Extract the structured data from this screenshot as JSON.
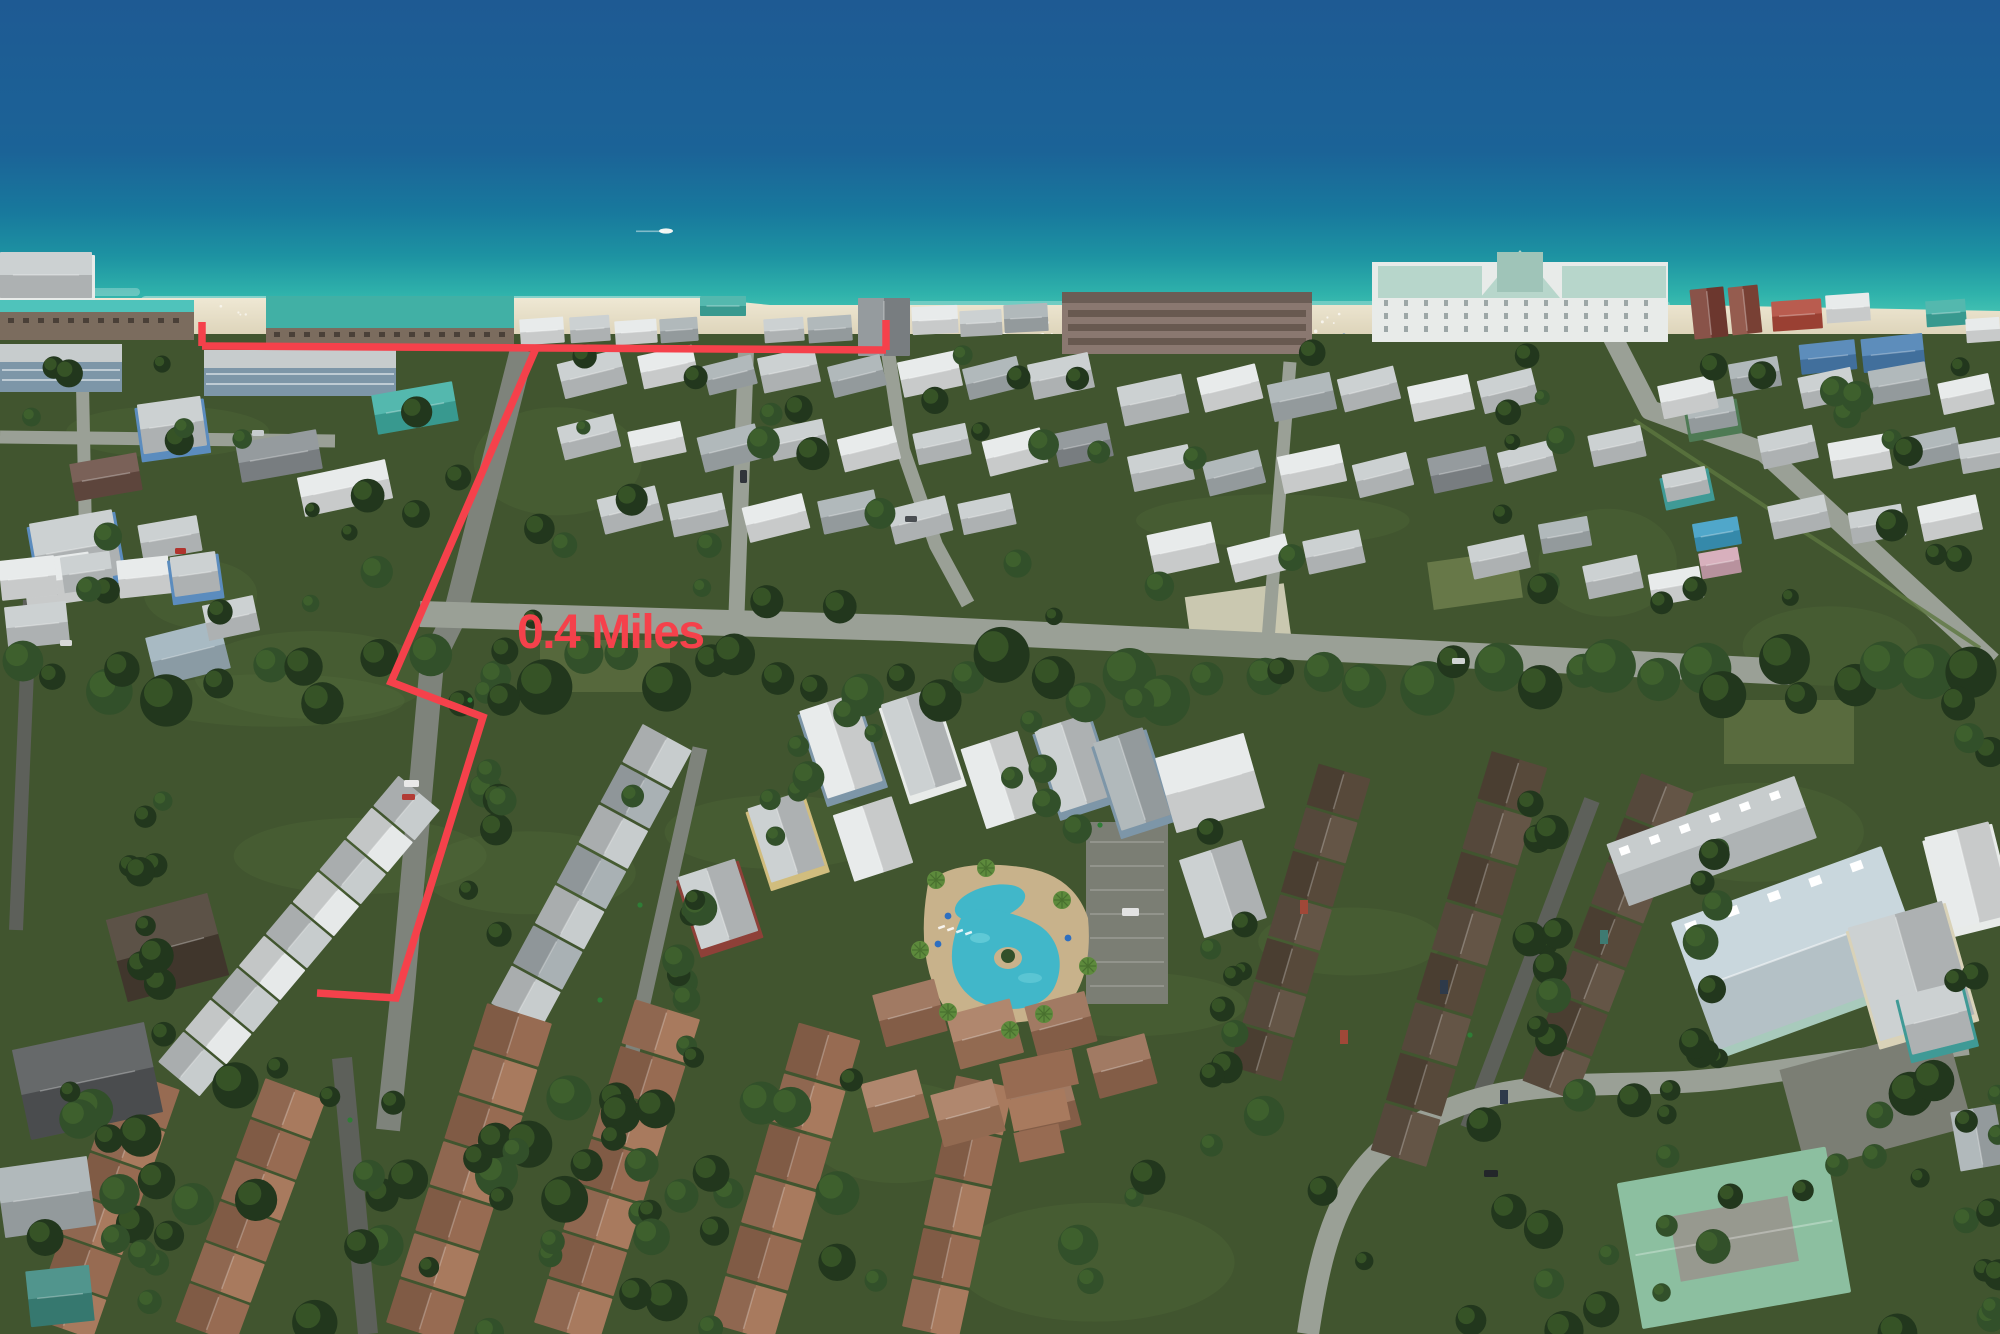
{
  "annotation": {
    "distance_label": "0.4 Miles",
    "color": "#f5414b",
    "stroke_width": 7.5,
    "label": {
      "x": 517,
      "y": 648,
      "font_size": 48
    },
    "beach_line": [
      [
        202,
        346
      ],
      [
        886,
        350
      ]
    ],
    "start_tick": [
      [
        202,
        346
      ],
      [
        202,
        322
      ]
    ],
    "end_tick": [
      [
        886,
        350
      ],
      [
        886,
        320
      ]
    ],
    "route_line": [
      [
        537,
        346
      ],
      [
        391,
        682
      ],
      [
        483,
        717
      ],
      [
        396,
        998
      ],
      [
        317,
        993
      ]
    ]
  },
  "scene": {
    "type": "aerial-photo",
    "subject": "beach neighborhood with route to shoreline marked in red",
    "palette": {
      "ocean_deep": "#1e5a93",
      "ocean_mid": "#1b6397",
      "ocean_teal": "#18799d",
      "ocean_bright": "#1d93a2",
      "ocean_turquoise": "#2fb2ab",
      "ocean_shallow": "#4ac7b5",
      "ocean_edge": "#69d8c1",
      "surf": "#eaf6ef",
      "sand": "#ece5d1",
      "sand_shadow": "#d2c8aa",
      "ground": "#41552f",
      "grass_light": "#5d7740",
      "scrub": "#87955c",
      "tree_dark": "#22371d",
      "tree_mid": "#32502a",
      "tree_light": "#49702f",
      "palm": "#5d8a3c",
      "road_light": "#9aa096",
      "road_mid": "#7e837b",
      "road_dark": "#5d605a",
      "parking": "#7b7e74",
      "roof_white": "#e6e9e9",
      "roof_silver": "#c7cccd",
      "roof_gray": "#a9b1b4",
      "roof_slate": "#8a9094",
      "roof_teal": "#41b0a5",
      "roof_seafoam": "#b7d6cb",
      "roof_blue": "#4b80b4",
      "roof_sky": "#3d9ec4",
      "roof_terracotta": "#976b52",
      "roof_terracotta_lt": "#a87a5e",
      "roof_dark_brown": "#57493a",
      "roof_dark_alt": "#645546",
      "roof_mint": "#8cbfa0",
      "roof_pale_blue": "#c9d7dd",
      "wall_white": "#e8ebe9",
      "wall_blue": "#5b8cbe",
      "wall_bluegray": "#7d96a8",
      "wall_brown": "#7b6c5e",
      "wall_mauve": "#8a7870",
      "wall_red": "#8e4038",
      "wall_yellow": "#d1bd7e",
      "wall_seafoam": "#a8cabc",
      "wall_teal_house": "#3f9a96",
      "wall_cream": "#d9d2b8",
      "pool_water": "#41b7c9",
      "pool_water_lt": "#79d8e0",
      "pool_deck": "#c8b28b",
      "umbrella_blue": "#2e6fc0",
      "boat_white": "#f2f5f2"
    }
  }
}
